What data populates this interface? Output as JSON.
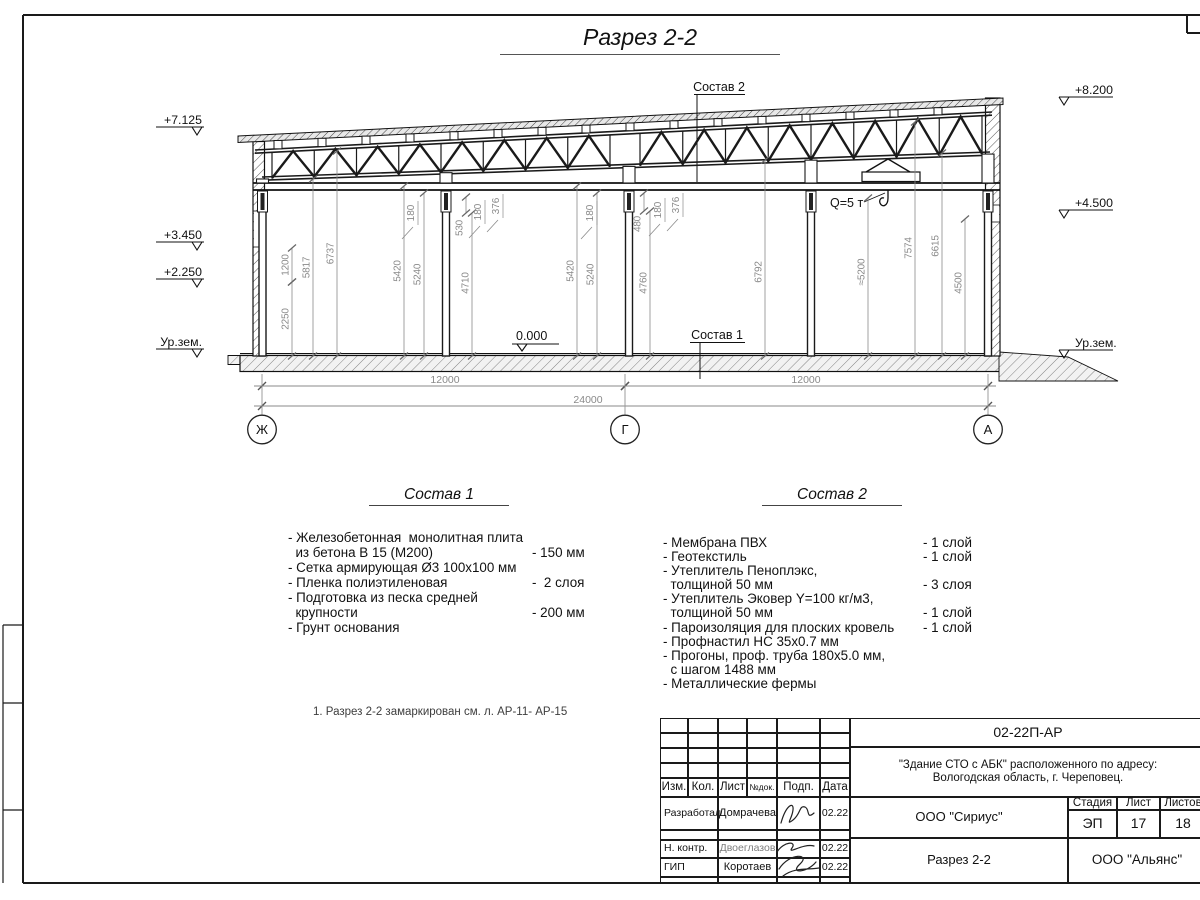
{
  "page_title": "Разрез 2-2",
  "colors": {
    "line": "#1a1a1a",
    "dim": "#8a8a8a"
  },
  "drawing": {
    "composition1_label": "Состав 1",
    "composition2_label": "Состав 2",
    "zero_mark_label": "0.000",
    "crane_label": "Q=5 т",
    "elevation_marks_left": [
      {
        "label": "+7.125",
        "baseline": 124
      },
      {
        "label": "+3.450",
        "baseline": 239
      },
      {
        "label": "+2.250",
        "baseline": 276
      },
      {
        "label": "Ур.зем.",
        "baseline": 346
      }
    ],
    "elevation_marks_right": [
      {
        "label": "+8.200",
        "baseline": 94
      },
      {
        "label": "+4.500",
        "baseline": 207
      },
      {
        "label": "Ур.зем.",
        "baseline": 347
      }
    ],
    "vertical_dims": [
      {
        "x": 292,
        "y1": 248,
        "y2": 282,
        "label": "1200"
      },
      {
        "x": 292,
        "y1": 282,
        "y2": 356,
        "label": "2250"
      },
      {
        "x": 313,
        "y1": 179,
        "y2": 356,
        "label": "5817"
      },
      {
        "x": 337,
        "y1": 151,
        "y2": 356,
        "label": "6737"
      },
      {
        "x": 404,
        "y1": 186,
        "y2": 356,
        "label": "5420"
      },
      {
        "x": 424,
        "y1": 193,
        "y2": 356,
        "label": "5240"
      },
      {
        "x": 466,
        "y1": 197,
        "y2": 213,
        "label": "530",
        "ly": 228
      },
      {
        "x": 472,
        "y1": 213,
        "y2": 356,
        "label": "4710",
        "ly": 283
      },
      {
        "x": 577,
        "y1": 186,
        "y2": 356,
        "label": "5420"
      },
      {
        "x": 597,
        "y1": 193,
        "y2": 356,
        "label": "5240"
      },
      {
        "x": 644,
        "y1": 193,
        "y2": 211,
        "label": "480",
        "ly": 224
      },
      {
        "x": 650,
        "y1": 211,
        "y2": 356,
        "label": "4760",
        "ly": 283
      },
      {
        "x": 765,
        "y1": 160,
        "y2": 356,
        "label": "6792",
        "ly": 272
      },
      {
        "x": 868,
        "y1": 198,
        "y2": 356,
        "label": "≈5200",
        "ly": 272
      },
      {
        "x": 915,
        "y1": 122,
        "y2": 356,
        "label": "7574",
        "ly": 248
      },
      {
        "x": 942,
        "y1": 153,
        "y2": 356,
        "label": "6615",
        "ly": 246
      },
      {
        "x": 965,
        "y1": 219,
        "y2": 356,
        "label": "4500",
        "ly": 283
      }
    ],
    "leader_dims": [
      {
        "x": 414,
        "y": 213,
        "label": "180"
      },
      {
        "x": 481,
        "y": 212,
        "label": "180"
      },
      {
        "x": 499,
        "y": 206,
        "label": "376"
      },
      {
        "x": 593,
        "y": 213,
        "label": "180"
      },
      {
        "x": 661,
        "y": 210,
        "label": "180"
      },
      {
        "x": 679,
        "y": 205,
        "label": "376"
      }
    ],
    "span_dims": [
      {
        "y": 386,
        "x1": 262,
        "x2": 625,
        "label": "12000",
        "lx": 445
      },
      {
        "y": 386,
        "x1": 625,
        "x2": 988,
        "label": "12000",
        "lx": 806
      },
      {
        "y": 406,
        "x1": 262,
        "x2": 988,
        "label": "24000",
        "lx": 588
      }
    ],
    "axis_bubbles": [
      {
        "label": "Ж",
        "x": 262
      },
      {
        "label": "Г",
        "x": 625
      },
      {
        "label": "А",
        "x": 988
      }
    ]
  },
  "composition1": {
    "title": "Состав 1",
    "rows": [
      {
        "t": "- Железобетонная  монолитная плита",
        "v": ""
      },
      {
        "t": "  из бетона В 15 (М200)",
        "v": "- 150 мм"
      },
      {
        "t": "- Сетка армирующая Ø3 100х100 мм",
        "v": ""
      },
      {
        "t": "- Пленка полиэтиленовая",
        "v": "-  2 слоя"
      },
      {
        "t": "- Подготовка из песка средней",
        "v": ""
      },
      {
        "t": "  крупности",
        "v": "- 200 мм"
      },
      {
        "t": "- Грунт основания",
        "v": ""
      }
    ]
  },
  "composition2": {
    "title": "Состав 2",
    "rows": [
      {
        "t": "- Мембрана ПВХ",
        "v": "- 1 слой"
      },
      {
        "t": "- Геотекстиль",
        "v": "- 1 слой"
      },
      {
        "t": "- Утеплитель Пеноплэкс,",
        "v": ""
      },
      {
        "t": "  толщиной 50 мм",
        "v": "- 3 слоя"
      },
      {
        "t": "- Утеплитель Эковер Y=100 кг/м3,",
        "v": ""
      },
      {
        "t": "  толщиной 50 мм",
        "v": "- 1 слой"
      },
      {
        "t": "- Пароизоляция для плоских кровель",
        "v": "- 1 слой"
      },
      {
        "t": "- Профнастил НС 35х0.7 мм",
        "v": ""
      },
      {
        "t": "- Прогоны, проф. труба 180х5.0 мм,",
        "v": ""
      },
      {
        "t": "  с шагом 1488 мм",
        "v": ""
      },
      {
        "t": "- Металлические фермы",
        "v": ""
      }
    ]
  },
  "note": "1. Разрез 2-2 замаркирован см. л. АР-11- АР-15",
  "titleblock": {
    "doc_number": "02-22П-АР",
    "project_line1": "\"Здание СТО с АБК\" расположенного по адресу:",
    "project_line2": "Вологодская область, г. Череповец.",
    "header_cols": [
      "Изм.",
      "Кол.",
      "Лист",
      "№док.",
      "Подп.",
      "Дата"
    ],
    "rows": [
      {
        "role": "Разработал",
        "name": "Домрачева",
        "date": "02.22"
      },
      {
        "role": "Н. контр.",
        "name": "Двоеглазов",
        "date": "02.22"
      },
      {
        "role": "ГИП",
        "name": "Коротаев",
        "date": "02.22"
      }
    ],
    "org_middle": "ООО \"Сириус\"",
    "sheet_title": "Разрез 2-2",
    "org_bottom": "ООО \"Альянс\"",
    "stage_label": "Стадия",
    "sheet_label": "Лист",
    "sheets_label": "Листов",
    "stage": "ЭП",
    "sheet": "17",
    "sheets": "18"
  }
}
